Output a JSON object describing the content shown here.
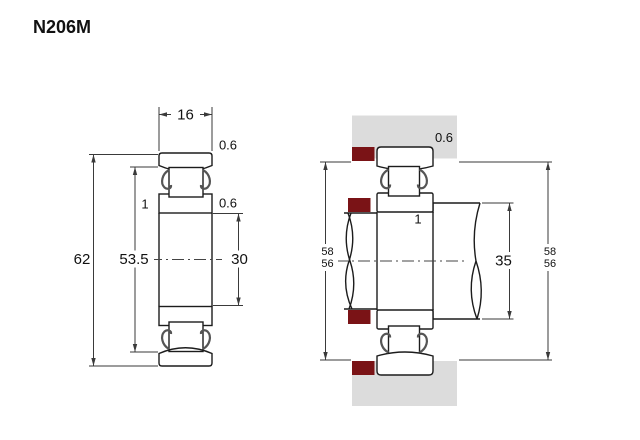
{
  "title": "N206M",
  "colors": {
    "ring_fill": "#d2532f",
    "spacer_fill": "#7a1316",
    "housing_fill": "#dcdcdc",
    "outline": "#1c1c1c",
    "dimension_line": "#3a3a3a"
  },
  "left_view": {
    "description": "bearing cross-section",
    "dim_width": "16",
    "dim_outer_chamfer": "0.6",
    "dim_inner_chamfer": "0.6",
    "dim_inner_chamfer_left": "1",
    "dim_outer_diameter": "62",
    "dim_shoulder_diameter": "53.5",
    "dim_bore_diameter": "30"
  },
  "right_view": {
    "description": "bearing mounted on shaft in housing",
    "dim_housing_chamfer": "0.6",
    "dim_inner_ring_chamfer": "1",
    "dim_shaft_diameter": "35",
    "dim_abutment_left_top": "58",
    "dim_abutment_left_bottom": "56",
    "dim_abutment_right_top": "58",
    "dim_abutment_right_bottom": "56"
  }
}
